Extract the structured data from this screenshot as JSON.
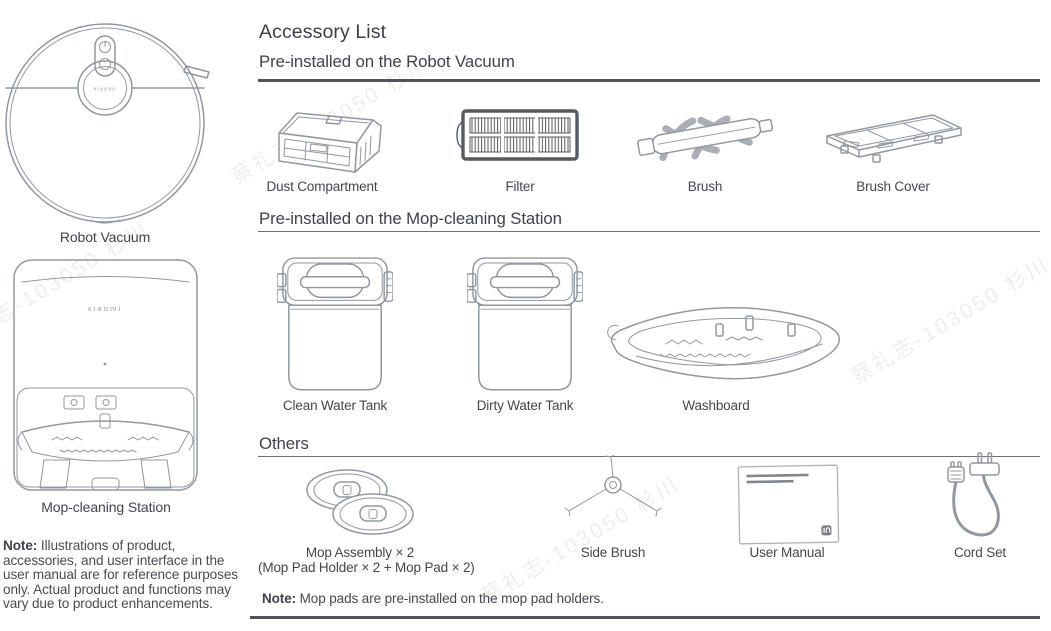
{
  "watermark": {
    "text": "蔡礼志-103050 杉川"
  },
  "left_panel": {
    "robot_brand": "xiaomi",
    "robot_vacuum_label": "Robot Vacuum",
    "station_brand": "xiaomi",
    "station_label": "Mop-cleaning Station",
    "note_bold": "Note:",
    "note_text": " Illustrations of product, accessories, and user interface in the user manual are for reference purposes only. Actual product and functions may vary due to product enhancements."
  },
  "accessory_list": {
    "title": "Accessory List",
    "sections": [
      {
        "heading": "Pre-installed on the Robot Vacuum",
        "items": [
          {
            "label": "Dust Compartment",
            "icon": "dust-compartment-icon"
          },
          {
            "label": "Filter",
            "icon": "filter-icon"
          },
          {
            "label": "Brush",
            "icon": "brush-icon"
          },
          {
            "label": "Brush Cover",
            "icon": "brush-cover-icon"
          }
        ]
      },
      {
        "heading": "Pre-installed on the Mop-cleaning Station",
        "items": [
          {
            "label": "Clean Water Tank",
            "icon": "clean-water-tank-icon"
          },
          {
            "label": "Dirty Water Tank",
            "icon": "dirty-water-tank-icon"
          },
          {
            "label": "Washboard",
            "icon": "washboard-icon"
          }
        ]
      },
      {
        "heading": "Others",
        "items": [
          {
            "label": "Mop Assembly × 2",
            "sublabel": "(Mop Pad Holder × 2 + Mop Pad × 2)",
            "icon": "mop-assembly-icon"
          },
          {
            "label": "Side Brush",
            "icon": "side-brush-icon"
          },
          {
            "label": "User Manual",
            "icon": "user-manual-icon"
          },
          {
            "label": "Cord Set",
            "icon": "cord-set-icon"
          }
        ]
      }
    ],
    "footnote_bold": "Note:",
    "footnote_text": " Mop pads are pre-installed on the mop pad holders."
  }
}
